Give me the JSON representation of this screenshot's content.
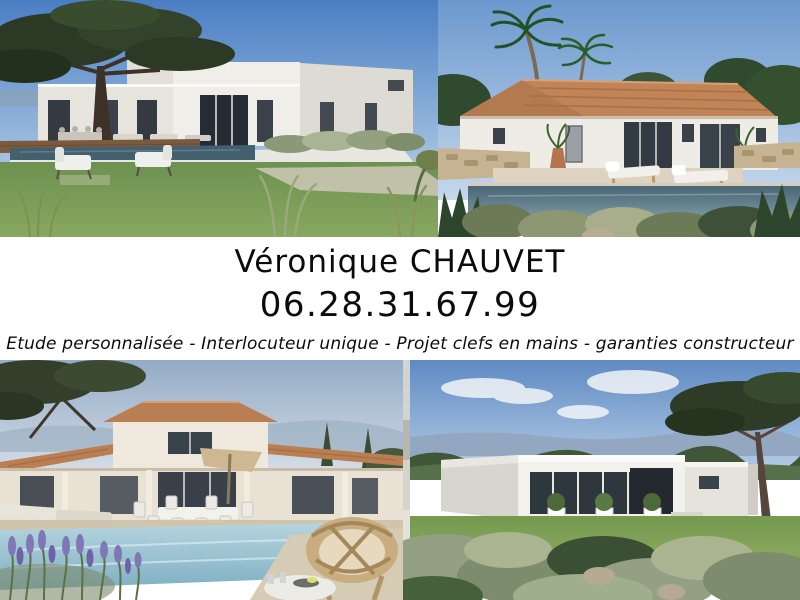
{
  "ad": {
    "agent_name": "Véronique CHAUVET",
    "phone": "06.28.31.67.99",
    "tagline": "Etude personnalisée - Interlocuteur unique - Projet clefs en mains - garanties constructeur"
  },
  "photos": [
    {
      "id": "top-left",
      "description": "Modern white flat-roof villa with infinity pool, wooden deck, large pine tree and lawn armchairs"
    },
    {
      "id": "top-right",
      "description": "Provençal single-storey villa with terracotta tiled roof, palm trees, stone walls, pool and two sun loungers"
    },
    {
      "id": "bottom-left",
      "description": "Two-storey Provençal villa with tiled roofs, veranda, outdoor dining set, large pool, lavender and rattan chair"
    },
    {
      "id": "bottom-right",
      "description": "Modern white flat-roof villa with glazed facade, lawn, silvery shrubs and tall pine tree"
    }
  ],
  "colors": {
    "band_background": "#ffffff",
    "text": "#0b0b0b",
    "sky_blue": "#4a7ec4",
    "sky_light": "#bcd1e8",
    "grass_green": "#6d9150",
    "roof_terracotta": "#c08457",
    "wall_white": "#efece5",
    "pool_dark": "#44606f",
    "pool_light": "#a8cdda",
    "lavender": "#8077b4",
    "stone_beige": "#c6b392"
  }
}
